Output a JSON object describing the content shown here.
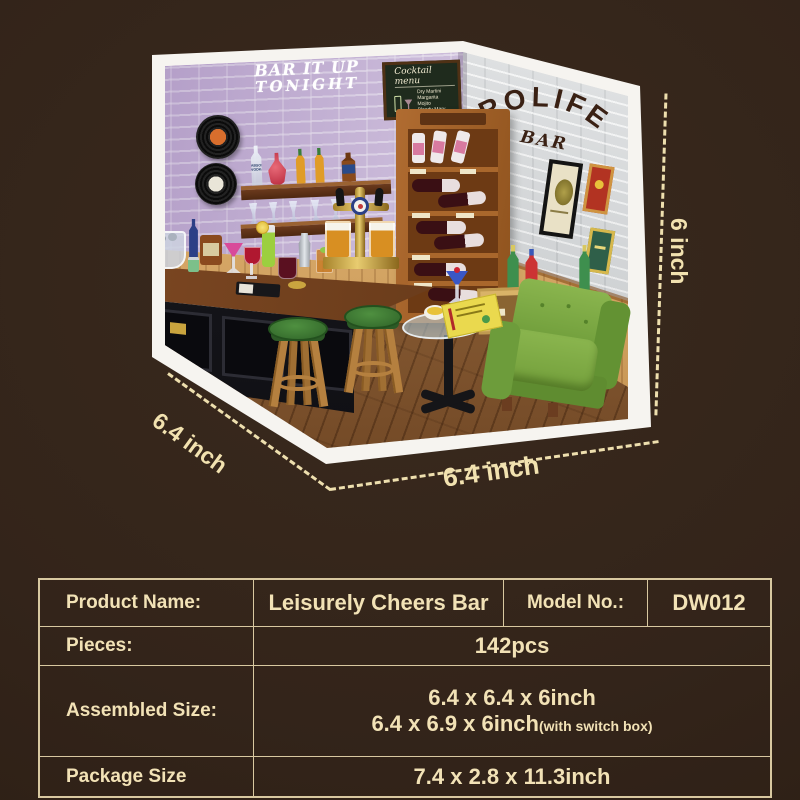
{
  "colors": {
    "page_background": "#33241a",
    "text_cream": "#f2e2b6",
    "table_border": "#d8c8a0",
    "dash_line": "#eedfae",
    "left_wall_brick": "#c8b5d9",
    "right_wall_brick": "#d0d3d5",
    "wainscot_wood": "#d9a55e",
    "floor_wood": "#8a5a30",
    "counter_black": "#141418",
    "stool_seat_green": "#3f7d35",
    "armchair_green": "#74a03c",
    "frame_white": "#f6f4f0"
  },
  "diorama": {
    "wall_sign": {
      "line1": "BAR IT UP",
      "line2": "TONIGHT"
    },
    "brand_sign": {
      "title": "ROLIFE",
      "subtitle": "BAR"
    },
    "chalkboard": {
      "title": "Cocktail menu",
      "items": [
        "Dry Martini",
        "Margarita",
        "Mojito",
        "Bloody Mary"
      ]
    },
    "vodka_label": "ABSOLUT VODKA",
    "dimensions": {
      "left": "6.4 inch",
      "bottom": "6.4 inch",
      "right": "6 inch"
    }
  },
  "spec_table": {
    "rows": [
      {
        "label": "Product Name:",
        "value": "Leisurely Cheers Bar",
        "label2": "Model No.:",
        "value2": "DW012"
      },
      {
        "label": "Pieces:",
        "value": "142pcs"
      },
      {
        "label": "Assembled Size:",
        "line1": "6.4 x 6.4 x 6inch",
        "line2": "6.4 x 6.9 x 6inch",
        "line2_note": "(with switch box)"
      },
      {
        "label": "Package Size",
        "value": "7.4 x 2.8 x 11.3inch"
      }
    ]
  }
}
